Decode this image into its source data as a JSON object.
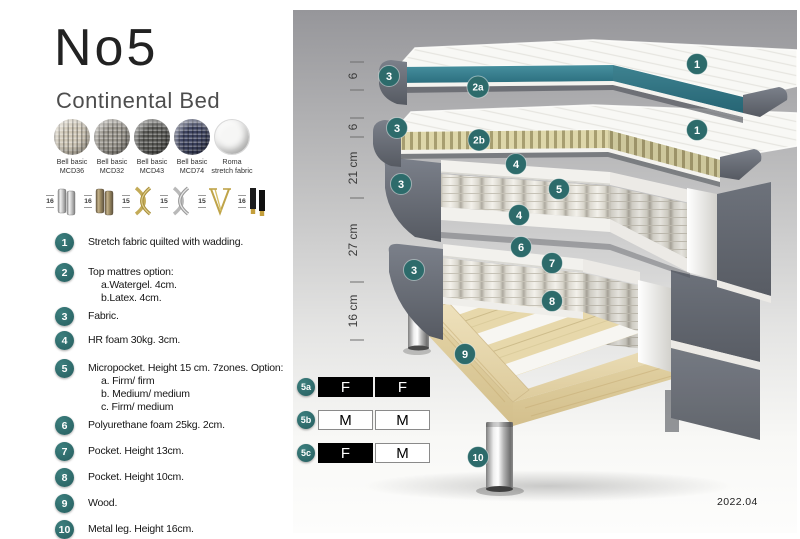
{
  "header": {
    "title": "No5",
    "subtitle": "Continental Bed"
  },
  "swatches": [
    {
      "line1": "Bell basic",
      "line2": "MCD36"
    },
    {
      "line1": "Bell basic",
      "line2": "MCD32"
    },
    {
      "line1": "Bell basic",
      "line2": "MCD43"
    },
    {
      "line1": "Bell basic",
      "line2": "MCD74"
    },
    {
      "line1": "Roma",
      "line2": "stretch fabric"
    }
  ],
  "legs_options": [
    {
      "height": "16"
    },
    {
      "height": "16"
    },
    {
      "height": "15"
    },
    {
      "height": "15"
    },
    {
      "height": "15"
    },
    {
      "height": "16"
    }
  ],
  "spec_list": [
    {
      "num": "1",
      "lines": [
        "Stretch fabric quilted with wadding."
      ]
    },
    {
      "num": "2",
      "lines": [
        "Top mattres option:",
        "a.Watergel. 4cm.",
        "b.Latex. 4cm."
      ]
    },
    {
      "num": "3",
      "lines": [
        "Fabric."
      ]
    },
    {
      "num": "4",
      "lines": [
        "HR foam 30kg. 3cm."
      ]
    },
    {
      "num": "5",
      "lines": [
        "Micropocket. Height 15 cm. 7zones. Option:",
        "a. Firm/ firm",
        "b. Medium/ medium",
        "c. Firm/ medium"
      ]
    },
    {
      "num": "6",
      "lines": [
        "Polyurethane foam 25kg. 2cm."
      ]
    },
    {
      "num": "7",
      "lines": [
        "Pocket. Height 13cm."
      ]
    },
    {
      "num": "8",
      "lines": [
        "Pocket. Height 10cm."
      ]
    },
    {
      "num": "9",
      "lines": [
        "Wood."
      ]
    },
    {
      "num": "10",
      "lines": [
        "Metal leg. Height 16cm."
      ]
    }
  ],
  "diagram": {
    "dimensions": [
      {
        "label": "6"
      },
      {
        "label": "6"
      },
      {
        "label": "21 cm"
      },
      {
        "label": "27 cm"
      },
      {
        "label": "16 cm"
      }
    ],
    "callouts": {
      "c1a": "1",
      "c3a": "3",
      "c2a": "2a",
      "c1b": "1",
      "c3b": "3",
      "c2b": "2b",
      "c4a": "4",
      "c5": "5",
      "c3c": "3",
      "c4b": "4",
      "c6": "6",
      "c7": "7",
      "c3d": "3",
      "c8": "8",
      "c9": "9",
      "c10": "10"
    },
    "firmness_table": [
      {
        "id": "5a",
        "left": "F",
        "right": "F",
        "left_style": "dark",
        "right_style": "dark"
      },
      {
        "id": "5b",
        "left": "M",
        "right": "M",
        "left_style": "light",
        "right_style": "light"
      },
      {
        "id": "5c",
        "left": "F",
        "right": "M",
        "left_style": "dark",
        "right_style": "light"
      }
    ],
    "version": "2022.04"
  },
  "colors": {
    "accent_teal": "#2d6b6b",
    "topper_teal": "#35808d",
    "fabric_gray": "#5e636b"
  }
}
